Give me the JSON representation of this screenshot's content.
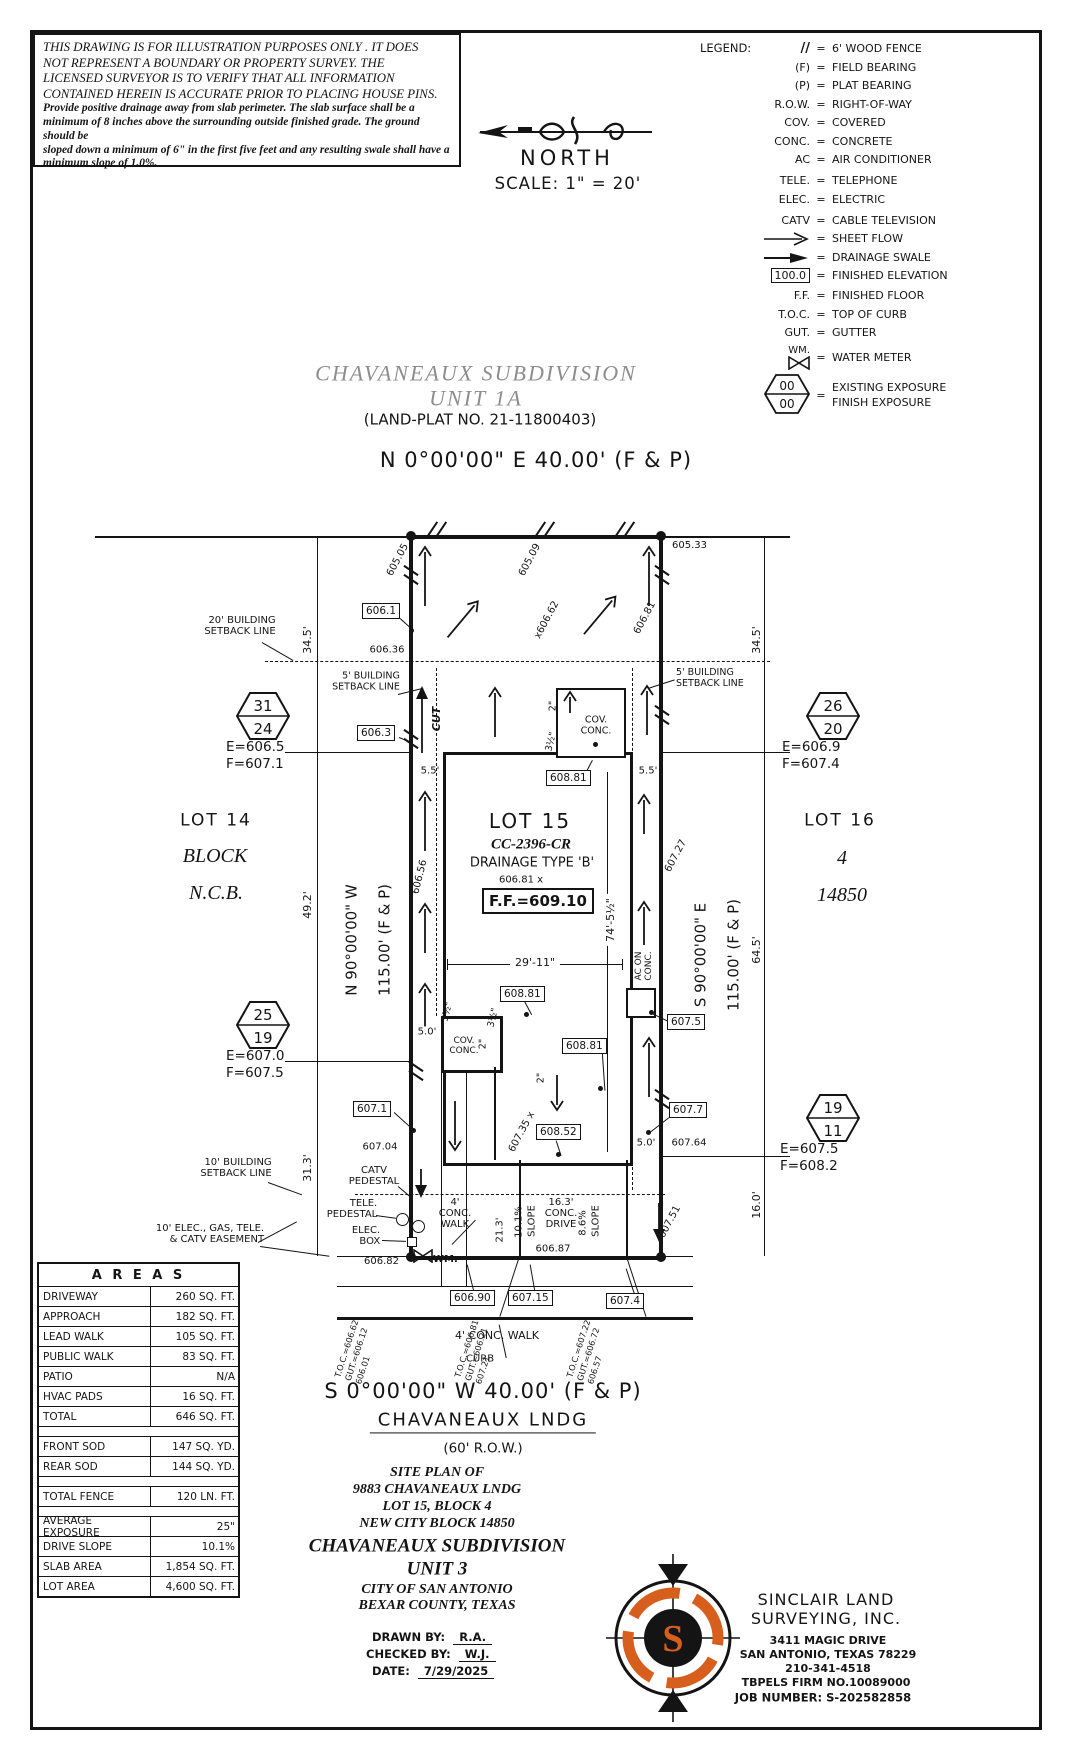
{
  "colors": {
    "accent": "#d65f1e",
    "title_gray": "#8d8d8d",
    "ink": "#141414",
    "paper": "#ffffff"
  },
  "disclaimer": {
    "para_1": "THIS DRAWING IS FOR ILLUSTRATION PURPOSES ONLY . IT DOES\nNOT REPRESENT A BOUNDARY OR PROPERTY SURVEY. THE\nLICENSED SURVEYOR IS TO VERIFY THAT ALL INFORMATION\nCONTAINED HEREIN IS ACCURATE PRIOR TO PLACING HOUSE PINS.",
    "para_2": "Provide positive drainage away from slab perimeter. The slab surface shall be a\nminimum of 8 inches above the surrounding outside finished grade. The ground should be\nsloped down a minimum of 6\" in the first five feet and any resulting swale shall have a\nminimum slope of 1.0%."
  },
  "compass": {
    "north": "NORTH",
    "scale": "SCALE: 1\" = 20'"
  },
  "legend": {
    "title": "LEGEND:",
    "items": [
      {
        "key": "//",
        "value": "6' WOOD FENCE"
      },
      {
        "key": "(F)",
        "value": "FIELD BEARING"
      },
      {
        "key": "(P)",
        "value": "PLAT BEARING"
      },
      {
        "key": "R.O.W.",
        "value": "RIGHT-OF-WAY"
      },
      {
        "key": "COV.",
        "value": "COVERED"
      },
      {
        "key": "CONC.",
        "value": "CONCRETE"
      },
      {
        "key": "AC",
        "value": "AIR CONDITIONER"
      },
      {
        "key": "TELE.",
        "value": "TELEPHONE"
      },
      {
        "key": "ELEC.",
        "value": "ELECTRIC"
      },
      {
        "key": "CATV",
        "value": "CABLE TELEVISION"
      },
      {
        "key": "",
        "value": "SHEET FLOW"
      },
      {
        "key": "",
        "value": "DRAINAGE SWALE"
      },
      {
        "key": "100.0",
        "value": "FINISHED ELEVATION"
      },
      {
        "key": "F.F.",
        "value": "FINISHED FLOOR"
      },
      {
        "key": "T.O.C.",
        "value": "TOP OF CURB"
      },
      {
        "key": "GUT.",
        "value": "GUTTER"
      },
      {
        "key": "WM.",
        "value": "WATER METER"
      },
      {
        "key": "00",
        "value": "EXISTING EXPOSURE"
      },
      {
        "key": "00",
        "value": "FINISH EXPOSURE"
      }
    ]
  },
  "subdivision": {
    "title_1": "CHAVANEAUX SUBDIVISION",
    "title_2": "UNIT 1A",
    "plat_no": "(LAND-PLAT NO. 21-11800403)"
  },
  "plat": {
    "bearing_north": "N 0°00'00\" E  40.00'  (F & P)",
    "bearing_south": "S 0°00'00\" W  40.00'  (F & P)",
    "bearing_west_1": "N 90°00'00\" W",
    "bearing_west_2": "115.00' (F & P)",
    "bearing_east_1": "S 90°00'00\" E",
    "bearing_east_2": "115.00' (F & P)",
    "street_name": "CHAVANEAUX LNDG",
    "street_row": "(60' R.O.W.)",
    "lot_left_1": "LOT 14",
    "lot_left_2": "BLOCK",
    "lot_left_3": "N.C.B.",
    "lot_center_1": "LOT 15",
    "lot_center_2": "CC-2396-CR",
    "lot_center_3": "DRAINAGE TYPE 'B'",
    "lot_right_1": "LOT 16",
    "lot_right_2": "4",
    "lot_right_3": "14850",
    "ff": "F.F.=609.10",
    "hex_31_24": {
      "a": "31",
      "b": "24",
      "e": "E=606.5",
      "f": "F=607.1"
    },
    "hex_25_19": {
      "a": "25",
      "b": "19",
      "e": "E=607.0",
      "f": "F=607.5"
    },
    "hex_26_20": {
      "a": "26",
      "b": "20",
      "e": "E=606.9",
      "f": "F=607.4"
    },
    "hex_19_11": {
      "a": "19",
      "b": "11",
      "e": "E=607.5",
      "f": "F=608.2"
    },
    "setback_20": "20' BUILDING\nSETBACK LINE",
    "setback_5_left": "5' BUILDING\nSETBACK LINE",
    "setback_5_right": "5' BUILDING\nSETBACK LINE",
    "setback_10": "10' BUILDING\nSETBACK LINE",
    "easement": "10' ELEC., GAS, TELE.\n& CATV EASEMENT",
    "catv_pedestal": "CATV\nPEDESTAL",
    "tele_pedestal": "TELE.\nPEDESTAL",
    "elec_box": "ELEC.\nBOX",
    "wm": "WM.",
    "cov_conc_rear": "COV.\nCONC.",
    "cov_conc_front": "COV.\nCONC.",
    "ac_on_conc": "AC ON\nCONC.",
    "cut": "CUT",
    "dim_345_l": "34.5'",
    "dim_492": "49.2'",
    "dim_313": "31.3'",
    "dim_345_r": "34.5'",
    "dim_645": "64.5'",
    "dim_160": "16.0'",
    "dim_55_l": "5.5'",
    "dim_55_r": "5.5'",
    "dim_50_l": "5.0'",
    "dim_50_r": "5.0'",
    "dim_2911": "29'-11\"",
    "dim_745": "74'-5½\"",
    "dim_213": "21.3'",
    "slope_drive": "10.1%",
    "slope_drive_w": "SLOPE",
    "slope_apron": "8.6%",
    "slope_apron_w": "SLOPE",
    "drive_label": "16.3'\nCONC.\nDRIVE",
    "walk_label": "4'\nCONC.\nWALK",
    "walk_street": "4' CONC. WALK",
    "curb": "CURB",
    "dim_2_rear": "2\"",
    "dim_2_front": "2\"",
    "dim_2_mid": "2\"",
    "dim_35_rear": "3½\"",
    "dim_35_front_a": "3½\"",
    "dim_35_front_b": "3½\"",
    "spot_60505": "605.05",
    "spot_60509": "605.09",
    "spot_60533": "605.33",
    "spot_6061": "606.1",
    "spot_60636": "606.36",
    "spot_6063": "606.3",
    "spot_60662": "x606.62",
    "spot_60681_ne": "606.81",
    "spot_60656": "606.56",
    "spot_60727": "607.27",
    "spot_60681_c": "606.81 x",
    "spot_60881": "608.81",
    "spot_60852": "608.52",
    "spot_60735": "607.35 x",
    "spot_6071": "607.1",
    "spot_60704": "607.04",
    "spot_6075": "607.5",
    "spot_6077": "607.7",
    "spot_60764": "607.64",
    "spot_60751": "607.51",
    "spot_60682": "606.82",
    "spot_60687": "606.87",
    "spot_60690": "606.90",
    "spot_60715": "607.15",
    "spot_6074": "607.4",
    "toc_1": "T.O.C.=606.62\nGUT.=606.12\n606.01",
    "toc_2": "T.O.C.=606.81\nGUT.=606.21\n607.21",
    "toc_3": "T.O.C.=607.22\nGUT.=606.72\n606.57"
  },
  "areas": {
    "title": "A R E A S",
    "rows": [
      {
        "label": "DRIVEWAY",
        "value": "260 SQ. FT."
      },
      {
        "label": "APPROACH",
        "value": "182 SQ. FT."
      },
      {
        "label": "LEAD WALK",
        "value": "105 SQ. FT."
      },
      {
        "label": "PUBLIC WALK",
        "value": "83 SQ. FT."
      },
      {
        "label": "PATIO",
        "value": "N/A"
      },
      {
        "label": "HVAC PADS",
        "value": "16 SQ. FT."
      },
      {
        "label": "TOTAL",
        "value": "646 SQ. FT."
      },
      {
        "label": "FRONT SOD",
        "value": "147 SQ. YD."
      },
      {
        "label": "REAR SOD",
        "value": "144 SQ. YD."
      },
      {
        "label": "TOTAL FENCE",
        "value": "120 LN. FT."
      },
      {
        "label": "AVERAGE EXPOSURE",
        "value": "25\""
      },
      {
        "label": "DRIVE SLOPE",
        "value": "10.1%"
      },
      {
        "label": "SLAB AREA",
        "value": "1,854 SQ. FT."
      },
      {
        "label": "LOT AREA",
        "value": "4,600 SQ. FT."
      }
    ]
  },
  "titleblock": {
    "lines": [
      "SITE PLAN OF",
      "9883 CHAVANEAUX LNDG",
      "LOT 15, BLOCK 4",
      "NEW CITY BLOCK 14850",
      "CHAVANEAUX SUBDIVISION",
      "UNIT 3",
      "CITY OF SAN ANTONIO",
      "BEXAR COUNTY, TEXAS"
    ],
    "drawn_label": "DRAWN BY:",
    "drawn": "R.A.",
    "checked_label": "CHECKED BY:",
    "checked": "W.J.",
    "date_label": "DATE:",
    "date": "7/29/2025"
  },
  "surveyor": {
    "name_1": "SINCLAIR LAND",
    "name_2": "SURVEYING, INC.",
    "address_1": "3411 MAGIC DRIVE",
    "address_2": "SAN ANTONIO, TEXAS 78229",
    "phone": "210-341-4518",
    "firm": "TBPELS FIRM NO.10089000",
    "job": "JOB NUMBER: S-202582858"
  }
}
